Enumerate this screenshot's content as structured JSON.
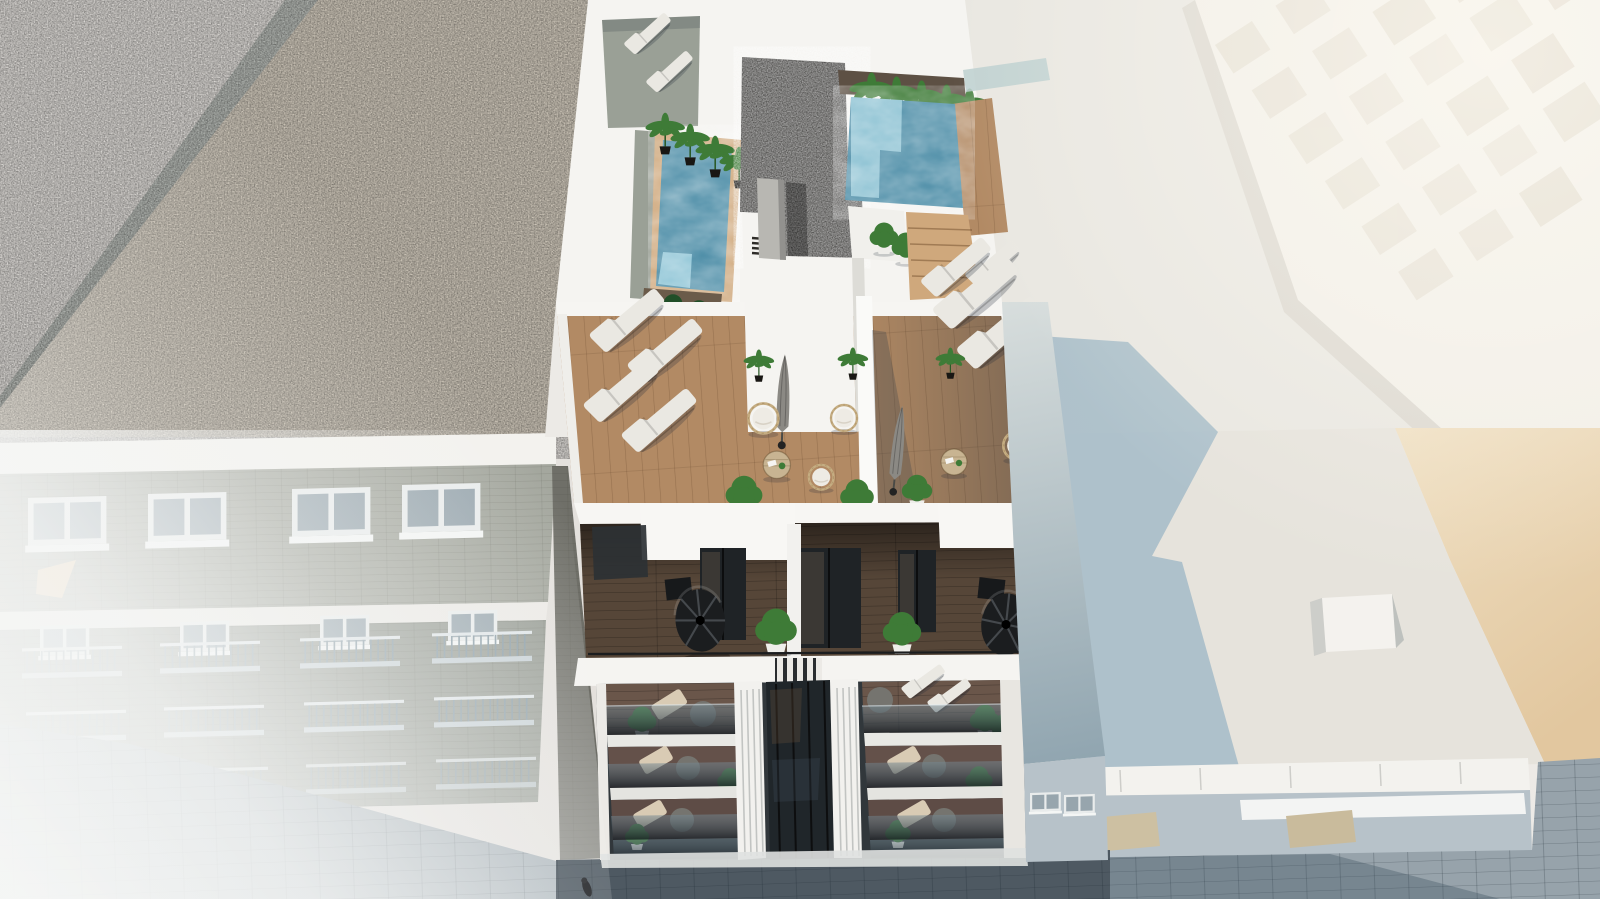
{
  "scene": {
    "description": "Aerial 3D architectural rendering of a modern white apartment block with two rooftop swimming pools, wooden roof terraces, spiral staircases and plant-filled balconies, flanked by a hazy brick building on the left and an overexposed white building on the right, above a paved street.",
    "view": "high aerial three-quarter view",
    "inventory": {
      "swimming_pools": 2,
      "spiral_staircases": 2,
      "closed_parasols": 2,
      "sun_loungers": 12,
      "rattan_hanging_chairs": 5,
      "round_terrace_tables": 2,
      "banana_plant_pots": 9,
      "green_shrub_pots": 8,
      "balcony_floors": 3,
      "rooftop_gravel_core": 1,
      "rooftop_ac_box": 1,
      "pedestrians": 1
    }
  },
  "colors": {
    "sky_top": "#f2f0ec",
    "sky_bottom": "#dcd8d4",
    "flat_roof": "#e4e1dd",
    "gravel_beige": "#d7cfc1",
    "gravel_dark": "#3e3d3b",
    "cornice_white": "#f3f2ee",
    "brick": "#a4a79e",
    "brick_dark": "#979c94",
    "building_white": "#f5f4f1",
    "wall_light": "#e9e7e1",
    "wall_shade": "#dddcd7",
    "pool_water": "#4b8ca6",
    "pool_shallow": "#9ed0df",
    "deck_wood": "#b28a64",
    "deck_wood_light": "#cfa87c",
    "deck_gray": "#9aa096",
    "terrace_wood": "#564638",
    "facade_dark": "#31373b",
    "recess_dark": "#20262a",
    "glass_dark": "#2c3134",
    "plant_green": "#3e7b37",
    "plant_dark": "#214f28",
    "furniture_white": "#eae8e2",
    "furniture_beige": "#d9cbb4",
    "table_wood": "#c8b492",
    "table_gray": "#75746f",
    "umbrella_gray": "#8b8984",
    "metal_dark": "#1b1d1f",
    "rattan": "#c5ad82",
    "roof_shadow": "#a9bec9",
    "rear_roof": "#e6e3dc",
    "sun_wall": "#ecd8ba",
    "tan_strip": "#e2b98d",
    "white_facade": "#f2efe8",
    "window_inset": "#e4ded2",
    "street_wall": "#b7c2c9",
    "pavers_light": "#97a3ab",
    "pavers_dark": "#4e5962"
  }
}
